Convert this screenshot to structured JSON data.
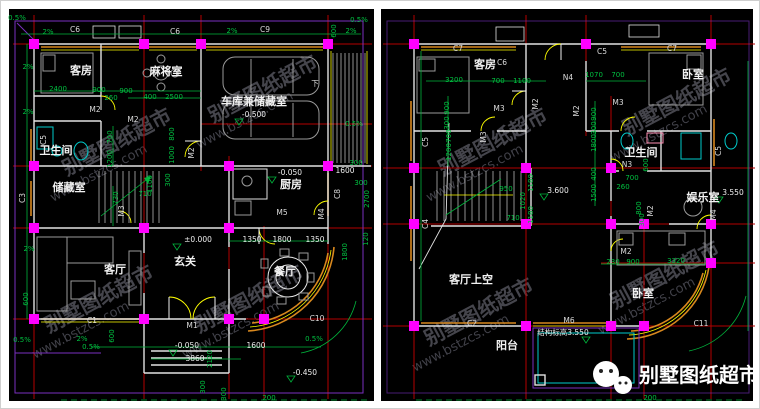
{
  "watermark": {
    "line1": "别墅图纸超市",
    "line2": "www.bstzcs.com",
    "positions": [
      {
        "x": 66,
        "y": 175
      },
      {
        "x": 48,
        "y": 332
      },
      {
        "x": 212,
        "y": 122
      },
      {
        "x": 198,
        "y": 332
      },
      {
        "x": 442,
        "y": 175
      },
      {
        "x": 428,
        "y": 345
      },
      {
        "x": 626,
        "y": 135
      },
      {
        "x": 614,
        "y": 308
      }
    ]
  },
  "logo": {
    "text": "别墅图纸超市"
  },
  "colors": {
    "background": "#000000",
    "grid_red": "#b40000",
    "dimension_green": "#00c040",
    "column_magenta": "#ff00ff",
    "window_orange": "#d8881e",
    "window_yellow": "#ffff00",
    "wall_white": "#e2e2e2",
    "fixture_cyan": "#00cccc",
    "balcony_purple": "#7a2fbf"
  },
  "plans": {
    "left": {
      "name": "一层平面图",
      "texts": [
        {
          "t": "0.5%",
          "x": 16,
          "y": 19,
          "k": "dim"
        },
        {
          "t": "2%",
          "x": 47,
          "y": 33,
          "k": "dim"
        },
        {
          "t": "C6",
          "x": 74,
          "y": 31,
          "k": "code"
        },
        {
          "t": "C6",
          "x": 174,
          "y": 33,
          "k": "code"
        },
        {
          "t": "2%",
          "x": 231,
          "y": 32,
          "k": "dim"
        },
        {
          "t": "C9",
          "x": 264,
          "y": 31,
          "k": "code"
        },
        {
          "t": "600",
          "x": 335,
          "y": 30,
          "k": "dim",
          "r": -90
        },
        {
          "t": "2%",
          "x": 350,
          "y": 32,
          "k": "dim"
        },
        {
          "t": "0.5%",
          "x": 358,
          "y": 21,
          "k": "dim"
        },
        {
          "t": "2%",
          "x": 27,
          "y": 68,
          "k": "dim"
        },
        {
          "t": "2%",
          "x": 27,
          "y": 113,
          "k": "dim"
        },
        {
          "t": "客房",
          "x": 80,
          "y": 73,
          "k": "room"
        },
        {
          "t": "麻将室",
          "x": 165,
          "y": 74,
          "k": "room"
        },
        {
          "t": "2400",
          "x": 57,
          "y": 90,
          "k": "dim"
        },
        {
          "t": "900",
          "x": 98,
          "y": 91,
          "k": "dim"
        },
        {
          "t": "900",
          "x": 125,
          "y": 92,
          "k": "dim"
        },
        {
          "t": "260",
          "x": 110,
          "y": 99,
          "k": "dim"
        },
        {
          "t": "400",
          "x": 149,
          "y": 98,
          "k": "dim"
        },
        {
          "t": "2500",
          "x": 173,
          "y": 98,
          "k": "dim"
        },
        {
          "t": "M2",
          "x": 94,
          "y": 111,
          "k": "code"
        },
        {
          "t": "M2",
          "x": 132,
          "y": 121,
          "k": "code"
        },
        {
          "t": "车库兼储藏室",
          "x": 253,
          "y": 104,
          "k": "room"
        },
        {
          "t": "-0.500",
          "x": 253,
          "y": 116,
          "k": "level"
        },
        {
          "t": "下",
          "x": 314,
          "y": 85,
          "k": "code"
        },
        {
          "t": "700",
          "x": 111,
          "y": 136,
          "k": "dim",
          "r": -90
        },
        {
          "t": "1200",
          "x": 111,
          "y": 158,
          "k": "dim",
          "r": -90
        },
        {
          "t": "800",
          "x": 173,
          "y": 133,
          "k": "dim",
          "r": -90
        },
        {
          "t": "1000",
          "x": 173,
          "y": 154,
          "k": "dim",
          "r": -90
        },
        {
          "t": "M2",
          "x": 193,
          "y": 152,
          "k": "code",
          "r": -90
        },
        {
          "t": "卫生间",
          "x": 55,
          "y": 153,
          "k": "room"
        },
        {
          "t": "C5",
          "x": 45,
          "y": 139,
          "k": "code",
          "r": -90
        },
        {
          "t": "储藏室",
          "x": 68,
          "y": 190,
          "k": "room"
        },
        {
          "t": "C3",
          "x": 24,
          "y": 197,
          "k": "code",
          "r": -90
        },
        {
          "t": "730",
          "x": 117,
          "y": 197,
          "k": "dim",
          "r": -90
        },
        {
          "t": "M3",
          "x": 123,
          "y": 210,
          "k": "code",
          "r": -90
        },
        {
          "t": "710",
          "x": 144,
          "y": 195,
          "k": "dim"
        },
        {
          "t": "1100",
          "x": 151,
          "y": 183,
          "k": "dim",
          "r": -90
        },
        {
          "t": "300",
          "x": 169,
          "y": 179,
          "k": "dim",
          "r": -90
        },
        {
          "t": "厨房",
          "x": 290,
          "y": 187,
          "k": "room"
        },
        {
          "t": "-0.050",
          "x": 289,
          "y": 174,
          "k": "level"
        },
        {
          "t": "M5",
          "x": 281,
          "y": 214,
          "k": "code"
        },
        {
          "t": "C8",
          "x": 339,
          "y": 193,
          "k": "code",
          "r": -90
        },
        {
          "t": "M4",
          "x": 323,
          "y": 213,
          "k": "code",
          "r": -90
        },
        {
          "t": "300",
          "x": 355,
          "y": 164,
          "k": "dim"
        },
        {
          "t": "1600",
          "x": 344,
          "y": 172,
          "k": "level"
        },
        {
          "t": "300",
          "x": 360,
          "y": 184,
          "k": "dim"
        },
        {
          "t": "2700",
          "x": 368,
          "y": 198,
          "k": "dim",
          "r": -90
        },
        {
          "t": "120",
          "x": 367,
          "y": 238,
          "k": "dim",
          "r": -90
        },
        {
          "t": "1800",
          "x": 346,
          "y": 251,
          "k": "dim",
          "r": -90
        },
        {
          "t": "0.5%",
          "x": 353,
          "y": 125,
          "k": "dim"
        },
        {
          "t": "1350",
          "x": 251,
          "y": 241,
          "k": "level"
        },
        {
          "t": "1800",
          "x": 281,
          "y": 241,
          "k": "level"
        },
        {
          "t": "1350",
          "x": 314,
          "y": 241,
          "k": "level"
        },
        {
          "t": "±0.000",
          "x": 197,
          "y": 241,
          "k": "level"
        },
        {
          "t": "玄关",
          "x": 184,
          "y": 264,
          "k": "room"
        },
        {
          "t": "客厅",
          "x": 114,
          "y": 272,
          "k": "room"
        },
        {
          "t": "餐厅",
          "x": 284,
          "y": 274,
          "k": "room"
        },
        {
          "t": "2%",
          "x": 28,
          "y": 250,
          "k": "dim"
        },
        {
          "t": "600",
          "x": 27,
          "y": 298,
          "k": "dim",
          "r": -90
        },
        {
          "t": "C1",
          "x": 91,
          "y": 322,
          "k": "code"
        },
        {
          "t": "M1",
          "x": 191,
          "y": 327,
          "k": "code"
        },
        {
          "t": "C10",
          "x": 316,
          "y": 320,
          "k": "code"
        },
        {
          "t": "0.5%",
          "x": 21,
          "y": 341,
          "k": "dim"
        },
        {
          "t": "2%",
          "x": 81,
          "y": 340,
          "k": "dim"
        },
        {
          "t": "0.5%",
          "x": 90,
          "y": 348,
          "k": "dim"
        },
        {
          "t": "600",
          "x": 113,
          "y": 335,
          "k": "dim",
          "r": -90
        },
        {
          "t": "-0.050",
          "x": 186,
          "y": 347,
          "k": "level"
        },
        {
          "t": "3860",
          "x": 194,
          "y": 360,
          "k": "level"
        },
        {
          "t": "2120",
          "x": 211,
          "y": 358,
          "k": "dim",
          "r": -90
        },
        {
          "t": "300",
          "x": 204,
          "y": 386,
          "k": "dim",
          "r": -90
        },
        {
          "t": "300",
          "x": 225,
          "y": 393,
          "k": "dim",
          "r": -90
        },
        {
          "t": "1600",
          "x": 255,
          "y": 347,
          "k": "level"
        },
        {
          "t": "0.5%",
          "x": 313,
          "y": 340,
          "k": "dim"
        },
        {
          "t": "-0.450",
          "x": 304,
          "y": 374,
          "k": "level"
        },
        {
          "t": "200",
          "x": 268,
          "y": 399,
          "k": "dim"
        }
      ]
    },
    "right": {
      "name": "二层平面图",
      "texts": [
        {
          "t": "C7",
          "x": 457,
          "y": 50,
          "k": "code"
        },
        {
          "t": "C6",
          "x": 501,
          "y": 64,
          "k": "code"
        },
        {
          "t": "C5",
          "x": 601,
          "y": 53,
          "k": "code"
        },
        {
          "t": "C7",
          "x": 671,
          "y": 50,
          "k": "code"
        },
        {
          "t": "客房",
          "x": 484,
          "y": 67,
          "k": "room"
        },
        {
          "t": "卧室",
          "x": 692,
          "y": 77,
          "k": "room"
        },
        {
          "t": "3200",
          "x": 453,
          "y": 81,
          "k": "dim"
        },
        {
          "t": "700",
          "x": 497,
          "y": 82,
          "k": "dim"
        },
        {
          "t": "1100",
          "x": 521,
          "y": 82,
          "k": "dim"
        },
        {
          "t": "N4",
          "x": 567,
          "y": 79,
          "k": "code"
        },
        {
          "t": "1070",
          "x": 593,
          "y": 76,
          "k": "dim"
        },
        {
          "t": "700",
          "x": 617,
          "y": 76,
          "k": "dim"
        },
        {
          "t": "M2",
          "x": 537,
          "y": 103,
          "k": "code",
          "r": -90
        },
        {
          "t": "M3",
          "x": 498,
          "y": 110,
          "k": "code"
        },
        {
          "t": "M3",
          "x": 617,
          "y": 104,
          "k": "code"
        },
        {
          "t": "M2",
          "x": 578,
          "y": 110,
          "k": "code",
          "r": -90
        },
        {
          "t": "900",
          "x": 448,
          "y": 107,
          "k": "dim",
          "r": -90
        },
        {
          "t": "300",
          "x": 448,
          "y": 122,
          "k": "dim",
          "r": -90
        },
        {
          "t": "700",
          "x": 450,
          "y": 135,
          "k": "dim",
          "r": -90
        },
        {
          "t": "1200",
          "x": 450,
          "y": 151,
          "k": "dim",
          "r": -90
        },
        {
          "t": "M3",
          "x": 485,
          "y": 136,
          "k": "code",
          "r": -90
        },
        {
          "t": "C5",
          "x": 427,
          "y": 141,
          "k": "code",
          "r": -90
        },
        {
          "t": "900",
          "x": 595,
          "y": 113,
          "k": "dim",
          "r": -90
        },
        {
          "t": "300",
          "x": 595,
          "y": 127,
          "k": "dim",
          "r": -90
        },
        {
          "t": "卫生间",
          "x": 640,
          "y": 155,
          "k": "room"
        },
        {
          "t": "N3",
          "x": 626,
          "y": 166,
          "k": "code"
        },
        {
          "t": "1800",
          "x": 595,
          "y": 142,
          "k": "dim",
          "r": -90
        },
        {
          "t": "400",
          "x": 595,
          "y": 173,
          "k": "dim",
          "r": -90
        },
        {
          "t": "1500",
          "x": 595,
          "y": 192,
          "k": "dim",
          "r": -90
        },
        {
          "t": "700",
          "x": 631,
          "y": 179,
          "k": "dim"
        },
        {
          "t": "260",
          "x": 622,
          "y": 188,
          "k": "dim"
        },
        {
          "t": "600",
          "x": 647,
          "y": 164,
          "k": "dim",
          "r": -90
        },
        {
          "t": "800",
          "x": 640,
          "y": 207,
          "k": "dim",
          "r": -90
        },
        {
          "t": "M2",
          "x": 652,
          "y": 210,
          "k": "code",
          "r": -90
        },
        {
          "t": "300",
          "x": 643,
          "y": 219,
          "k": "dim",
          "r": -90
        },
        {
          "t": "娱乐室",
          "x": 702,
          "y": 200,
          "k": "room"
        },
        {
          "t": "3.550",
          "x": 732,
          "y": 194,
          "k": "level"
        },
        {
          "t": "C5",
          "x": 720,
          "y": 150,
          "k": "code",
          "r": -90
        },
        {
          "t": "M4",
          "x": 715,
          "y": 214,
          "k": "code",
          "r": -90
        },
        {
          "t": "C4",
          "x": 427,
          "y": 223,
          "k": "code",
          "r": -90
        },
        {
          "t": "3.600",
          "x": 557,
          "y": 192,
          "k": "level"
        },
        {
          "t": "950",
          "x": 505,
          "y": 190,
          "k": "dim"
        },
        {
          "t": "1020",
          "x": 524,
          "y": 200,
          "k": "dim",
          "r": -90
        },
        {
          "t": "1180",
          "x": 532,
          "y": 182,
          "k": "dim",
          "r": -90
        },
        {
          "t": "1180",
          "x": 532,
          "y": 214,
          "k": "dim",
          "r": -90
        },
        {
          "t": "710",
          "x": 512,
          "y": 219,
          "k": "dim"
        },
        {
          "t": "客厅上空",
          "x": 470,
          "y": 282,
          "k": "room"
        },
        {
          "t": "C2",
          "x": 471,
          "y": 325,
          "k": "code"
        },
        {
          "t": "M6",
          "x": 568,
          "y": 322,
          "k": "code"
        },
        {
          "t": "结构标高3.550",
          "x": 562,
          "y": 334,
          "k": "level"
        },
        {
          "t": "阳台",
          "x": 506,
          "y": 348,
          "k": "room"
        },
        {
          "t": "M2",
          "x": 625,
          "y": 253,
          "k": "code"
        },
        {
          "t": "230",
          "x": 612,
          "y": 263,
          "k": "dim"
        },
        {
          "t": "900",
          "x": 632,
          "y": 263,
          "k": "dim"
        },
        {
          "t": "3320",
          "x": 675,
          "y": 262,
          "k": "dim"
        },
        {
          "t": "卧室",
          "x": 642,
          "y": 296,
          "k": "room"
        },
        {
          "t": "C11",
          "x": 700,
          "y": 325,
          "k": "code"
        },
        {
          "t": "200",
          "x": 649,
          "y": 399,
          "k": "dim"
        }
      ]
    }
  }
}
